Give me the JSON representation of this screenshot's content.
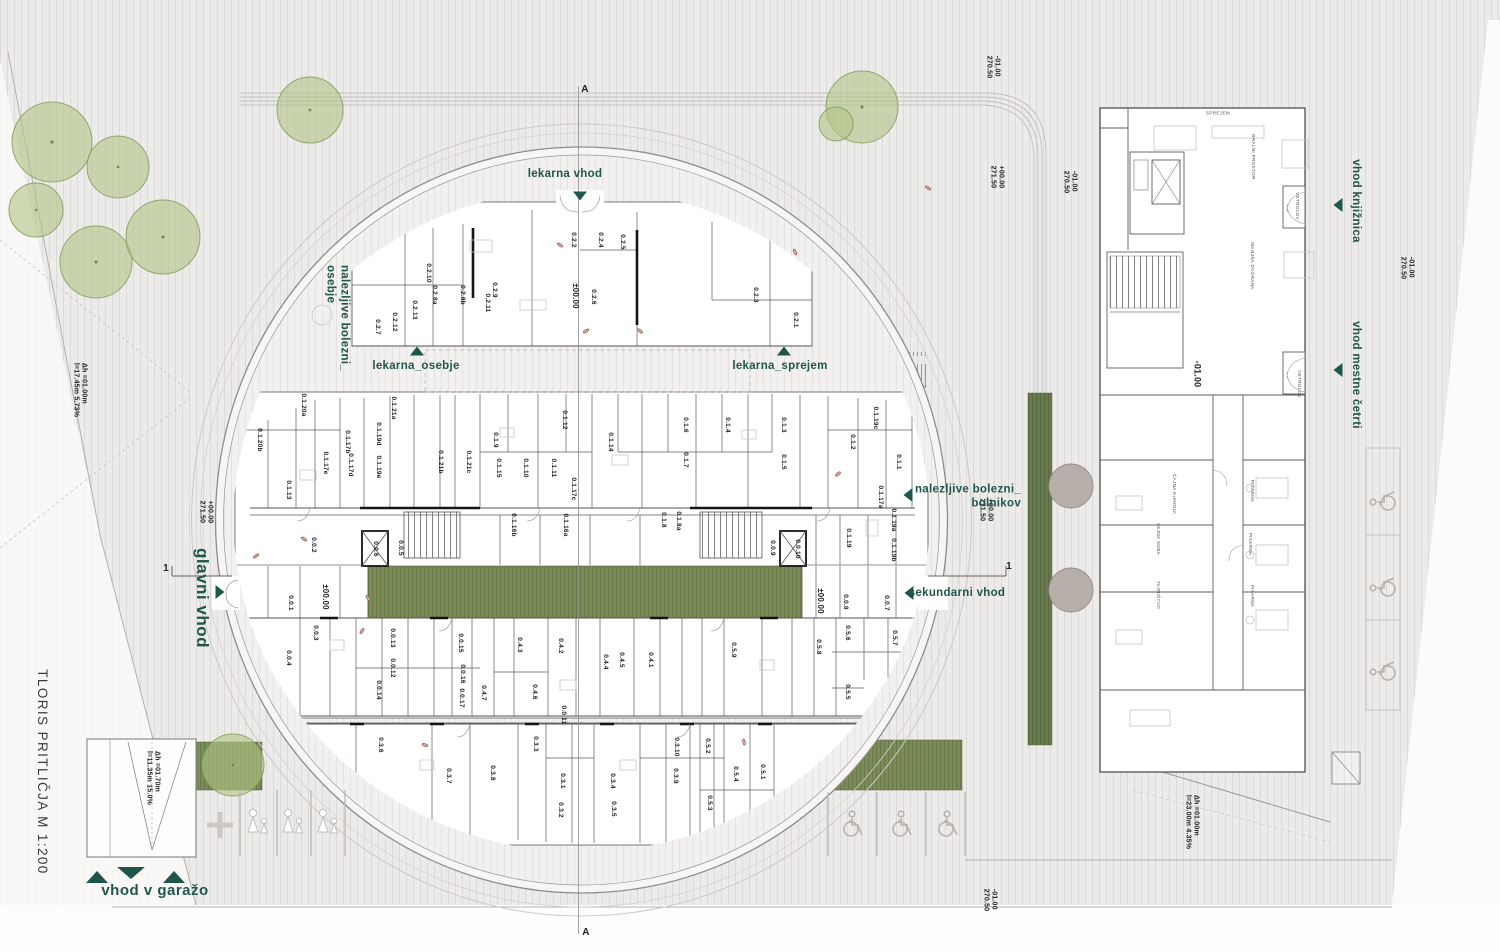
{
  "plan": {
    "title": {
      "text": "TLORIS PRITLIČJA M 1:200",
      "x": 42,
      "y": 772
    },
    "colors": {
      "teal": "#1f564c",
      "green_strip": "#7b8c58",
      "green_dark": "#687a4d",
      "tree_green": "#b0c486",
      "tree_gray": "#b6afaa",
      "wall": "#151515"
    },
    "entrance_labels": [
      {
        "label": "lekarna vhod",
        "x": 565,
        "y": 174
      },
      {
        "label": "lekarna_osebje",
        "x": 416,
        "y": 366
      },
      {
        "label": "lekarna_sprejem",
        "x": 780,
        "y": 366
      },
      {
        "label": "nalezljive bolezni_\nosebje",
        "x": 337,
        "y": 318,
        "rot": 90
      },
      {
        "label": "nalezljive bolezni_\nbolnikov",
        "x": 968,
        "y": 497,
        "align": "right"
      },
      {
        "label": "sekundarni vhod",
        "x": 957,
        "y": 593
      },
      {
        "label": "glavni vhod",
        "x": 202,
        "y": 598,
        "rot": 90,
        "cls": "teal-big"
      },
      {
        "label": "vhod v garažo",
        "x": 155,
        "y": 891,
        "cls": "teal-big",
        "fs": 15
      },
      {
        "label": "vhod knjižnica",
        "x": 1356,
        "y": 201,
        "rot": 90
      },
      {
        "label": "vhod mestne četrti",
        "x": 1356,
        "y": 375,
        "rot": 90
      }
    ],
    "arrows": [
      {
        "dir": "down",
        "x": 580,
        "y": 196
      },
      {
        "dir": "up",
        "x": 417,
        "y": 351
      },
      {
        "dir": "up",
        "x": 784,
        "y": 351
      },
      {
        "dir": "left",
        "x": 908,
        "y": 495
      },
      {
        "dir": "left",
        "x": 909,
        "y": 593
      },
      {
        "dir": "right",
        "x": 220,
        "y": 592
      },
      {
        "dir": "left",
        "x": 1338,
        "y": 205
      },
      {
        "dir": "left",
        "x": 1338,
        "y": 370
      },
      {
        "dir": "up",
        "x": 97,
        "y": 877,
        "big": true
      },
      {
        "dir": "down",
        "x": 131,
        "y": 873,
        "big": true
      },
      {
        "dir": "up",
        "x": 174,
        "y": 877,
        "big": true
      }
    ],
    "section_markers": [
      {
        "label": "A",
        "x": 585,
        "y": 90
      },
      {
        "label": "A",
        "x": 586,
        "y": 933
      },
      {
        "label": "1",
        "x": 166,
        "y": 569
      },
      {
        "label": "1",
        "x": 1009,
        "y": 567
      }
    ],
    "levels": [
      {
        "lines": [
          "-01.00",
          "270.50"
        ],
        "x": 992,
        "y": 67
      },
      {
        "lines": [
          "+00.00",
          "271.50"
        ],
        "x": 996,
        "y": 177
      },
      {
        "lines": [
          "-01.00",
          "270.50"
        ],
        "x": 1069,
        "y": 182
      },
      {
        "lines": [
          "+00.00",
          "271.50"
        ],
        "x": 205,
        "y": 512
      },
      {
        "lines": [
          "+00.00",
          "271.50"
        ],
        "x": 985,
        "y": 510
      },
      {
        "lines": [
          "-01.00",
          "270.50"
        ],
        "x": 1406,
        "y": 268
      },
      {
        "lines": [
          "-01.00",
          "270.50"
        ],
        "x": 989,
        "y": 900
      },
      {
        "lines": [
          "-01.00"
        ],
        "x": 1197,
        "y": 374,
        "fs": 9
      }
    ],
    "datums": [
      {
        "n": "±00.00",
        "x": 575,
        "y": 296
      },
      {
        "n": "±00.00",
        "x": 325,
        "y": 597
      },
      {
        "n": "±00.00",
        "x": 820,
        "y": 601
      }
    ],
    "ramp_labels": [
      {
        "lines": [
          "Δh =01.00m",
          "l=17.45m 5.73%"
        ],
        "x": 79,
        "y": 390
      },
      {
        "lines": [
          "Δh =01.70m",
          "l=11.35m 15.0%"
        ],
        "x": 152,
        "y": 778
      },
      {
        "lines": [
          "Δh =01.00m",
          "l=23.00m 4.35%"
        ],
        "x": 1191,
        "y": 822
      }
    ],
    "rooms": [
      {
        "n": "0.2.1",
        "x": 795,
        "y": 320
      },
      {
        "n": "0.2.2",
        "x": 573,
        "y": 240
      },
      {
        "n": "0.2.3",
        "x": 755,
        "y": 295
      },
      {
        "n": "0.2.4",
        "x": 600,
        "y": 240
      },
      {
        "n": "0.2.5",
        "x": 622,
        "y": 242
      },
      {
        "n": "0.2.6",
        "x": 593,
        "y": 297
      },
      {
        "n": "0.2.7",
        "x": 377,
        "y": 327
      },
      {
        "n": "0.2.8a",
        "x": 434,
        "y": 295
      },
      {
        "n": "0.2.8b",
        "x": 462,
        "y": 295
      },
      {
        "n": "0.2.9",
        "x": 494,
        "y": 290
      },
      {
        "n": "0.2.10",
        "x": 428,
        "y": 273
      },
      {
        "n": "0.2.11",
        "x": 487,
        "y": 303
      },
      {
        "n": "0.2.12",
        "x": 394,
        "y": 322
      },
      {
        "n": "0.2.13",
        "x": 414,
        "y": 310
      },
      {
        "n": "0.1.1",
        "x": 898,
        "y": 462
      },
      {
        "n": "0.1.2",
        "x": 852,
        "y": 442
      },
      {
        "n": "0.1.3",
        "x": 783,
        "y": 425
      },
      {
        "n": "0.1.4",
        "x": 727,
        "y": 425
      },
      {
        "n": "0.1.5",
        "x": 783,
        "y": 462
      },
      {
        "n": "0.1.6",
        "x": 685,
        "y": 425
      },
      {
        "n": "0.1.7",
        "x": 685,
        "y": 460
      },
      {
        "n": "0.1.8",
        "x": 663,
        "y": 520
      },
      {
        "n": "0.1.8a",
        "x": 678,
        "y": 521
      },
      {
        "n": "0.1.9",
        "x": 495,
        "y": 440
      },
      {
        "n": "0.1.10",
        "x": 525,
        "y": 468
      },
      {
        "n": "0.1.11",
        "x": 553,
        "y": 468
      },
      {
        "n": "0.1.12",
        "x": 564,
        "y": 420
      },
      {
        "n": "0.1.13",
        "x": 288,
        "y": 490
      },
      {
        "n": "0.1.14",
        "x": 610,
        "y": 442
      },
      {
        "n": "0.1.15",
        "x": 498,
        "y": 468
      },
      {
        "n": "0.1.16a",
        "x": 565,
        "y": 525
      },
      {
        "n": "0.1.16b",
        "x": 513,
        "y": 525
      },
      {
        "n": "0.1.17a",
        "x": 880,
        "y": 497
      },
      {
        "n": "0.1.17b",
        "x": 347,
        "y": 442
      },
      {
        "n": "0.1.17c",
        "x": 573,
        "y": 489
      },
      {
        "n": "0.1.17d",
        "x": 350,
        "y": 465
      },
      {
        "n": "0.1.17e",
        "x": 325,
        "y": 463
      },
      {
        "n": "0.1.19",
        "x": 848,
        "y": 538
      },
      {
        "n": "0.1.19a",
        "x": 893,
        "y": 520
      },
      {
        "n": "0.1.19b",
        "x": 893,
        "y": 550
      },
      {
        "n": "0.1.19c",
        "x": 875,
        "y": 418
      },
      {
        "n": "0.1.19d",
        "x": 378,
        "y": 434
      },
      {
        "n": "0.1.19e",
        "x": 378,
        "y": 467
      },
      {
        "n": "0.1.20a",
        "x": 303,
        "y": 405
      },
      {
        "n": "0.1.20b",
        "x": 259,
        "y": 440
      },
      {
        "n": "0.1.21a",
        "x": 393,
        "y": 408
      },
      {
        "n": "0.1.21b",
        "x": 440,
        "y": 462
      },
      {
        "n": "0.1.21c",
        "x": 468,
        "y": 462
      },
      {
        "n": "0.0.1",
        "x": 290,
        "y": 603
      },
      {
        "n": "0.0.2",
        "x": 313,
        "y": 545
      },
      {
        "n": "0.0.3",
        "x": 315,
        "y": 633
      },
      {
        "n": "0.0.4",
        "x": 288,
        "y": 658
      },
      {
        "n": "0.0.5",
        "x": 400,
        "y": 548
      },
      {
        "n": "0.0.6",
        "x": 375,
        "y": 549
      },
      {
        "n": "0.0.7",
        "x": 886,
        "y": 603
      },
      {
        "n": "0.0.8",
        "x": 845,
        "y": 602
      },
      {
        "n": "0.0.9",
        "x": 772,
        "y": 548
      },
      {
        "n": "0.0.10",
        "x": 797,
        "y": 549
      },
      {
        "n": "0.0.11",
        "x": 563,
        "y": 715
      },
      {
        "n": "0.0.12",
        "x": 392,
        "y": 668
      },
      {
        "n": "0.0.13",
        "x": 392,
        "y": 638
      },
      {
        "n": "0.0.14",
        "x": 378,
        "y": 690
      },
      {
        "n": "0.0.15",
        "x": 460,
        "y": 643
      },
      {
        "n": "0.0.16",
        "x": 462,
        "y": 674
      },
      {
        "n": "0.0.17",
        "x": 461,
        "y": 698
      },
      {
        "n": "0.4.1",
        "x": 650,
        "y": 660
      },
      {
        "n": "0.4.2",
        "x": 560,
        "y": 646
      },
      {
        "n": "0.4.3",
        "x": 519,
        "y": 645
      },
      {
        "n": "0.4.4",
        "x": 605,
        "y": 662
      },
      {
        "n": "0.4.5",
        "x": 621,
        "y": 660
      },
      {
        "n": "0.4.6",
        "x": 534,
        "y": 692
      },
      {
        "n": "0.4.7",
        "x": 483,
        "y": 693
      },
      {
        "n": "0.5.1",
        "x": 762,
        "y": 772
      },
      {
        "n": "0.5.2",
        "x": 707,
        "y": 746
      },
      {
        "n": "0.5.3",
        "x": 709,
        "y": 803
      },
      {
        "n": "0.5.4",
        "x": 735,
        "y": 774
      },
      {
        "n": "0.5.5",
        "x": 847,
        "y": 692
      },
      {
        "n": "0.5.6",
        "x": 847,
        "y": 633
      },
      {
        "n": "0.5.7",
        "x": 894,
        "y": 638
      },
      {
        "n": "0.5.8",
        "x": 818,
        "y": 647
      },
      {
        "n": "0.5.9",
        "x": 733,
        "y": 650
      },
      {
        "n": "0.3.1",
        "x": 562,
        "y": 781
      },
      {
        "n": "0.3.2",
        "x": 560,
        "y": 810
      },
      {
        "n": "0.3.3",
        "x": 535,
        "y": 744
      },
      {
        "n": "0.3.4",
        "x": 612,
        "y": 781
      },
      {
        "n": "0.3.5",
        "x": 613,
        "y": 809
      },
      {
        "n": "0.3.6",
        "x": 380,
        "y": 745
      },
      {
        "n": "0.3.7",
        "x": 448,
        "y": 776
      },
      {
        "n": "0.3.8",
        "x": 492,
        "y": 773
      },
      {
        "n": "0.3.9",
        "x": 675,
        "y": 776
      },
      {
        "n": "0.3.10",
        "x": 676,
        "y": 747
      }
    ],
    "right_building": {
      "rooms": [
        {
          "n": "SPREJEM",
          "x": 1218,
          "y": 113,
          "rot": 0
        },
        {
          "n": "BRALNI PROSTOR",
          "x": 1253,
          "y": 157,
          "rot": 90
        },
        {
          "n": "MANJŠA DVORANA",
          "x": 1252,
          "y": 266,
          "rot": 90
        },
        {
          "n": "VETROLOV",
          "x": 1297,
          "y": 206,
          "rot": 90
        },
        {
          "n": "VETROLOV",
          "x": 1299,
          "y": 384,
          "rot": 90
        },
        {
          "n": "ČAJNA KUHINJA",
          "x": 1174,
          "y": 494,
          "rot": 90
        },
        {
          "n": "SEJNA SOBA",
          "x": 1158,
          "y": 539,
          "rot": 90
        },
        {
          "n": "TAJNIŠTVO",
          "x": 1158,
          "y": 595,
          "rot": 90
        },
        {
          "n": "PISARNA",
          "x": 1252,
          "y": 491,
          "rot": 90
        },
        {
          "n": "PISARNA",
          "x": 1250,
          "y": 544,
          "rot": 90
        },
        {
          "n": "PISARNA",
          "x": 1252,
          "y": 596,
          "rot": 90
        }
      ]
    }
  }
}
